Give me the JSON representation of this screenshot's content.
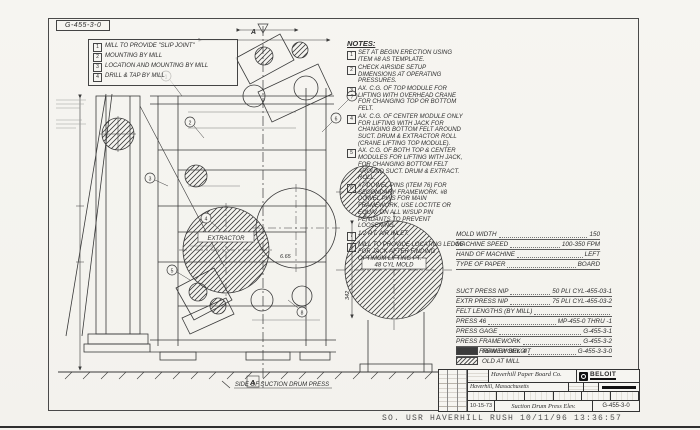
{
  "sheet": {
    "corner_label": "G-455-3-0",
    "legend_items": [
      {
        "num": "1",
        "text": "MILL TO PROVIDE \"SLIP JOINT\""
      },
      {
        "num": "2",
        "text": "MOUNTING BY MILL"
      },
      {
        "num": "3",
        "text": "LOCATION AND MOUNTING BY MILL"
      },
      {
        "num": "4",
        "text": "DRILL & TAP BY MILL"
      }
    ],
    "notes": {
      "title": "NOTES:",
      "items": [
        {
          "num": "1",
          "text": "SET AT BEGIN ERECTION USING ITEM #8 AS TEMPLATE."
        },
        {
          "num": "2",
          "text": "CHECK AIRSIDE SETUP DIMENSIONS AT OPERATING PRESSURES."
        },
        {
          "num": "3",
          "text": "AX. C.G. OF TOP MODULE FOR LIFTING WITH OVERHEAD CRANE FOR CHANGING TOP OR BOTTOM FELT."
        },
        {
          "num": "4",
          "text": "AX. C.G. OF CENTER MODULE ONLY FOR LIFTING WITH JACK FOR CHANGING BOTTOM FELT AROUND SUCT. DRUM & EXTRACTOR ROLL (CRANE LIFTING TOP MODULE)."
        },
        {
          "num": "5",
          "text": "AX. C.G. OF BOTH TOP & CENTER MODULES FOR LIFTING WITH JACK, FOR CHANGING BOTTOM FELT AROUND SUCT. DRUM & EXTRACT. ROLL."
        },
        {
          "num": "6",
          "text": "#7 DOWEL PINS (ITEM 76) FOR SECONDARY FRAMEWORK. #8 DOWEL PINS FOR MAIN FRAMEWORK, USE LOCTITE OR EQUIV. ON ALL W/SUP PIN PENDANTS TO PREVENT LOOSENING."
        },
        {
          "num": "7",
          "text": "1/2 P.T. AIR INLET."
        },
        {
          "num": "8",
          "text": "MILL TO PROVIDE LOCATING LEDGE FOR JACK AFTER FINDING OPTIMUM LIFTING PT."
        }
      ]
    },
    "machine_table": {
      "rows": [
        {
          "label": "MOLD WIDTH",
          "value": "150"
        },
        {
          "label": "MACHINE SPEED",
          "value": "100-350 FPM"
        },
        {
          "label": "HAND OF MACHINE",
          "value": "LEFT"
        },
        {
          "label": "TYPE OF PAPER",
          "value": "BOARD"
        }
      ]
    },
    "press_table": {
      "rows": [
        {
          "label": "SUCT PRESS NIP",
          "mid": "50 PLI",
          "value": "CYL-455-03-1"
        },
        {
          "label": "EXTR PRESS NIP",
          "mid": "75 PLI",
          "value": "CYL-455-03-2"
        },
        {
          "label": "FELT LENGTHS (BY MILL)",
          "mid": "",
          "value": ""
        },
        {
          "label": "PRESS 46",
          "mid": "",
          "value": "MP-455-0 THRU -1"
        },
        {
          "label": "PRESS GAGE",
          "mid": "",
          "value": "G-455-3-1"
        },
        {
          "label": "PRESS FRAMEWORK",
          "mid": "",
          "value": "G-455-3-2"
        },
        {
          "label": "PRESS FRAMEWORK 4",
          "mid": "",
          "value": "G-455-3-3-0"
        }
      ],
      "new_label": "NEW BY BELOIT",
      "old_label": "OLD AT MILL"
    },
    "title_block": {
      "customer_line1": "Haverhill Paper Board Co.",
      "customer_line2": "Haverhill, Massachusetts",
      "brand": "BELOIT",
      "date": "10-15-73",
      "title": "Suction Drum Press Elev.",
      "dwg_no": "G-455-3-0"
    }
  },
  "drawing": {
    "mold_label": "48 CYL MOLD",
    "extractor_label": "EXTRACTOR",
    "baseline_label": "SIDE OF SUCTION DRUM PRESS",
    "dim_342": "342",
    "dim_665": "6.65",
    "section_flag": "A",
    "balloons": [
      "1",
      "2",
      "3",
      "4",
      "5",
      "6",
      "7",
      "8"
    ]
  },
  "footer": {
    "text": "SO. USR HAVERHILL RUSH 10/11/96 13:36:57"
  }
}
